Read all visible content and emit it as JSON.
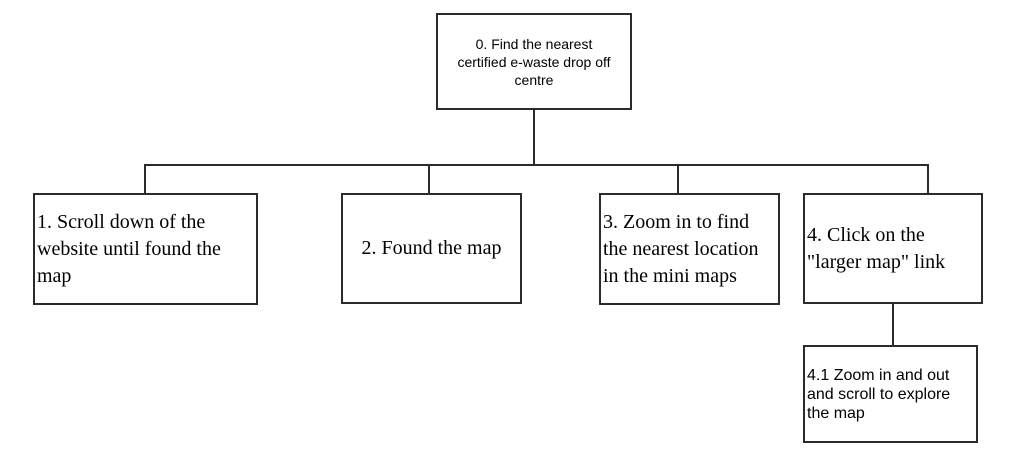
{
  "colors": {
    "line": "#2b2b2b",
    "text": "#000000",
    "background": "#ffffff"
  },
  "flowchart": {
    "type": "tree-flowchart",
    "root": {
      "id": "0",
      "label": "0. Find the nearest\ncertified e-waste drop off\ncentre"
    },
    "children": [
      {
        "id": "1",
        "label": "1. Scroll down of the\nwebsite until found the\nmap"
      },
      {
        "id": "2",
        "label": "2. Found the map"
      },
      {
        "id": "3",
        "label": "3. Zoom in to find\nthe nearest location\nin the mini maps"
      },
      {
        "id": "4",
        "label": "4. Click on the\n\"larger map\" link",
        "children": [
          {
            "id": "4.1",
            "label": "4.1 Zoom in and out\nand scroll to explore\nthe map"
          }
        ]
      }
    ]
  }
}
